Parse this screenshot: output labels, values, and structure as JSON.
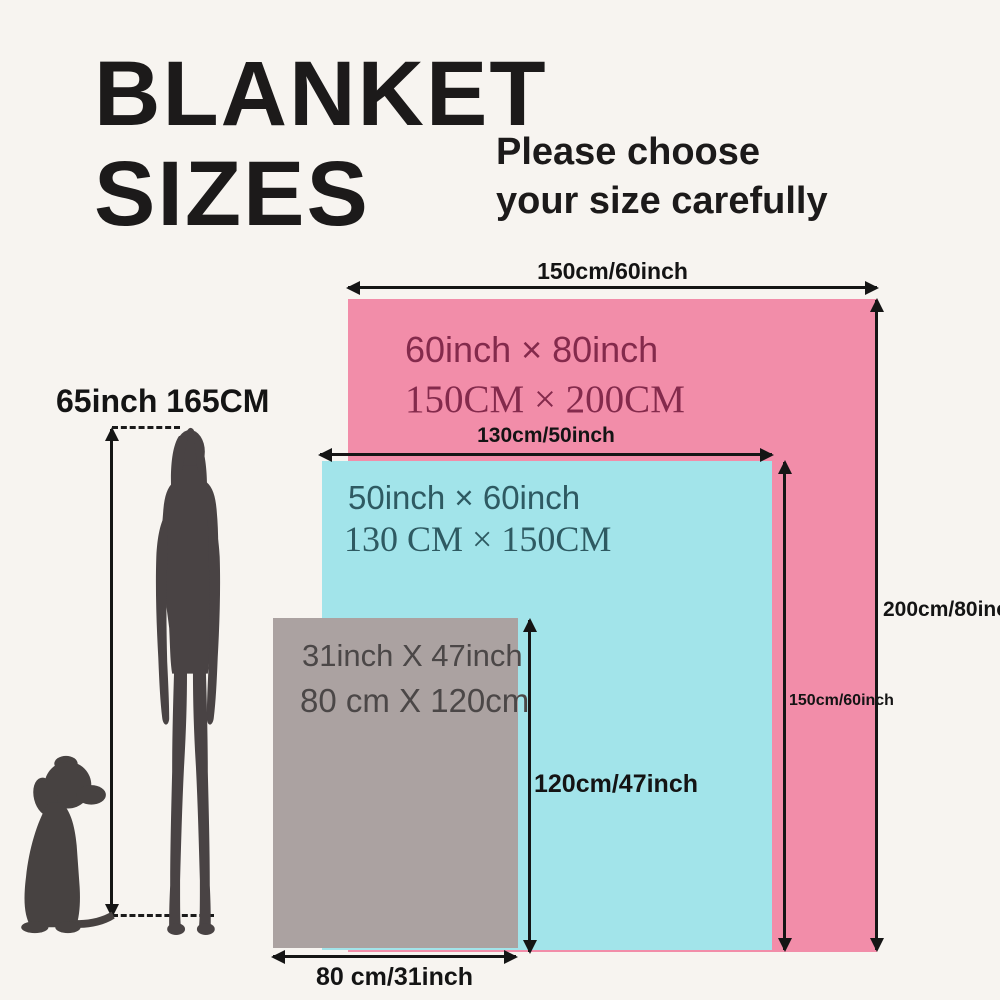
{
  "title": {
    "line1": "BLANKET",
    "line2": "SIZES"
  },
  "subtitle": {
    "line1": "Please choose",
    "line2": "your size carefully"
  },
  "person": {
    "height_label": "65inch 165CM",
    "silhouette_color": "#494344"
  },
  "dog": {
    "silhouette_color": "#474241"
  },
  "blankets": {
    "large": {
      "color": "#f28da9",
      "text_color": "#842a4c",
      "inch_label": "60inch × 80inch",
      "cm_label": "150CM × 200CM",
      "width_measure": "150cm/60inch",
      "height_measure": "200cm/80inch"
    },
    "medium": {
      "color": "#a2e4ea",
      "text_color": "#2e5a62",
      "inch_label": "50inch × 60inch",
      "cm_label": "130 CM × 150CM",
      "width_measure": "130cm/50inch",
      "height_measure": "150cm/60inch"
    },
    "small": {
      "color": "#aba2a1",
      "text_color": "#4b4747",
      "inch_label": "31inch X 47inch",
      "cm_label": "80 cm X 120cm",
      "width_measure": "80 cm/31inch",
      "height_measure": "120cm/47inch"
    }
  }
}
